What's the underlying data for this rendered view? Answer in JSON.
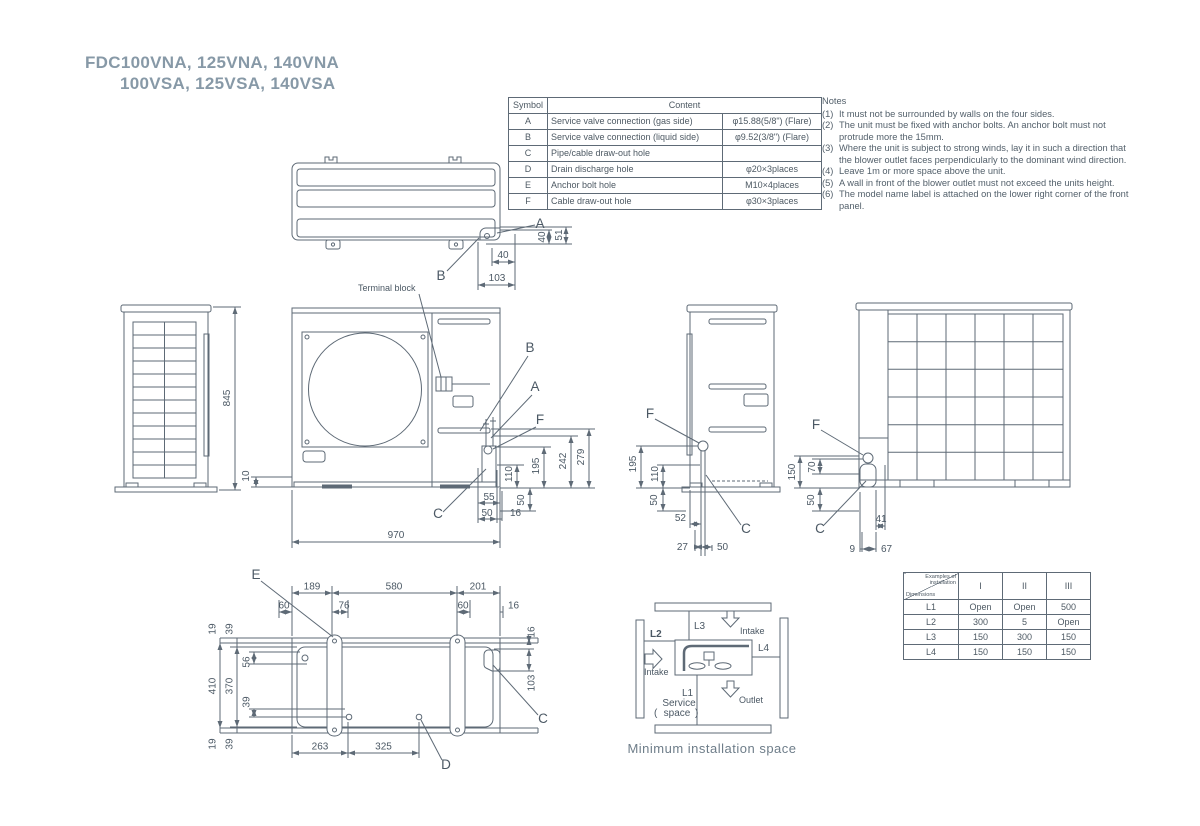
{
  "page": {
    "background": "#ffffff",
    "line_color": "#5e6a76",
    "text_color": "#4b5864",
    "title_color": "#8799a7"
  },
  "title": {
    "line1": "FDC100VNA, 125VNA, 140VNA",
    "line2": "100VSA, 125VSA, 140VSA"
  },
  "symbol_table": {
    "header_symbol": "Symbol",
    "header_content": "Content",
    "rows": [
      {
        "symbol": "A",
        "content": "Service valve connection (gas side)",
        "value": "φ15.88(5/8\") (Flare)"
      },
      {
        "symbol": "B",
        "content": "Service valve connection (liquid side)",
        "value": "φ9.52(3/8\") (Flare)"
      },
      {
        "symbol": "C",
        "content": "Pipe/cable draw-out hole",
        "value": ""
      },
      {
        "symbol": "D",
        "content": "Drain discharge hole",
        "value": "φ20×3places"
      },
      {
        "symbol": "E",
        "content": "Anchor bolt hole",
        "value": "M10×4places"
      },
      {
        "symbol": "F",
        "content": "Cable draw-out hole",
        "value": "φ30×3places"
      }
    ]
  },
  "notes": {
    "title": "Notes",
    "items": [
      {
        "num": "(1)",
        "text": "It must not be surrounded by walls on the four sides."
      },
      {
        "num": "(2)",
        "text": "The unit must be fixed with anchor bolts. An anchor bolt must not protrude more the 15mm."
      },
      {
        "num": "(3)",
        "text": "Where the unit is subject to strong winds, lay it in such a direction that the blower outlet faces perpendicularly to the dominant wind direction."
      },
      {
        "num": "(4)",
        "text": "Leave 1m or more space above the unit."
      },
      {
        "num": "(5)",
        "text": "A wall in front of the blower outlet must not exceed the units height."
      },
      {
        "num": "(6)",
        "text": "The model name label is attached on the lower right corner of the front panel."
      }
    ]
  },
  "annotations": {
    "terminal_block": "Terminal block"
  },
  "callouts": {
    "top": {
      "a": "A",
      "b": "B"
    },
    "front": {
      "a": "A",
      "b": "B",
      "f": "F",
      "c": "C"
    },
    "side": {
      "f": "F",
      "c": "C"
    },
    "back": {
      "f": "F",
      "c": "C"
    },
    "bottom": {
      "e": "E",
      "d": "D",
      "c": "C"
    }
  },
  "dims": {
    "top": {
      "w40": "40",
      "w103": "103",
      "h40": "40",
      "h51": "51"
    },
    "left": {
      "h845": "845"
    },
    "front": {
      "h10": "10",
      "w970": "970",
      "r110": "110",
      "r195": "195",
      "r242": "242",
      "r279": "279",
      "r50": "50",
      "b55": "55",
      "b50": "50",
      "b16": "16"
    },
    "side": {
      "v195": "195",
      "v110": "110",
      "v50": "50",
      "h52": "52",
      "h27": "27",
      "h50": "50"
    },
    "back": {
      "v150": "150",
      "v70": "70",
      "v50": "50",
      "h41": "41",
      "h9": "9",
      "h67": "67"
    },
    "bottom": {
      "t189": "189",
      "t580": "580",
      "t201": "201",
      "s60a": "60",
      "s76": "76",
      "s60b": "60",
      "s16": "16",
      "l19a": "19",
      "l39a": "39",
      "l56": "56",
      "l410": "410",
      "l370": "370",
      "l39m": "39",
      "l19b": "19",
      "l39b": "39",
      "b263": "263",
      "b325": "325",
      "r16": "16",
      "r103": "103"
    }
  },
  "min_space": {
    "l1": "L1",
    "l2": "L2",
    "l3": "L3",
    "l4": "L4",
    "intake_top": "Intake",
    "intake_left": "Intake",
    "outlet": "Outlet",
    "paren_open": "(",
    "service_line1": "Service",
    "service_line2": "space",
    "paren_close": ")",
    "caption": "Minimum installation space"
  },
  "install_table": {
    "corner_top": "Examples of installation",
    "corner_bottom": "Dimensions",
    "columns": [
      "I",
      "II",
      "III"
    ],
    "rows": [
      {
        "label": "L1",
        "values": [
          "Open",
          "Open",
          "500"
        ]
      },
      {
        "label": "L2",
        "values": [
          "300",
          "5",
          "Open"
        ]
      },
      {
        "label": "L3",
        "values": [
          "150",
          "300",
          "150"
        ]
      },
      {
        "label": "L4",
        "values": [
          "150",
          "150",
          "150"
        ]
      }
    ]
  }
}
